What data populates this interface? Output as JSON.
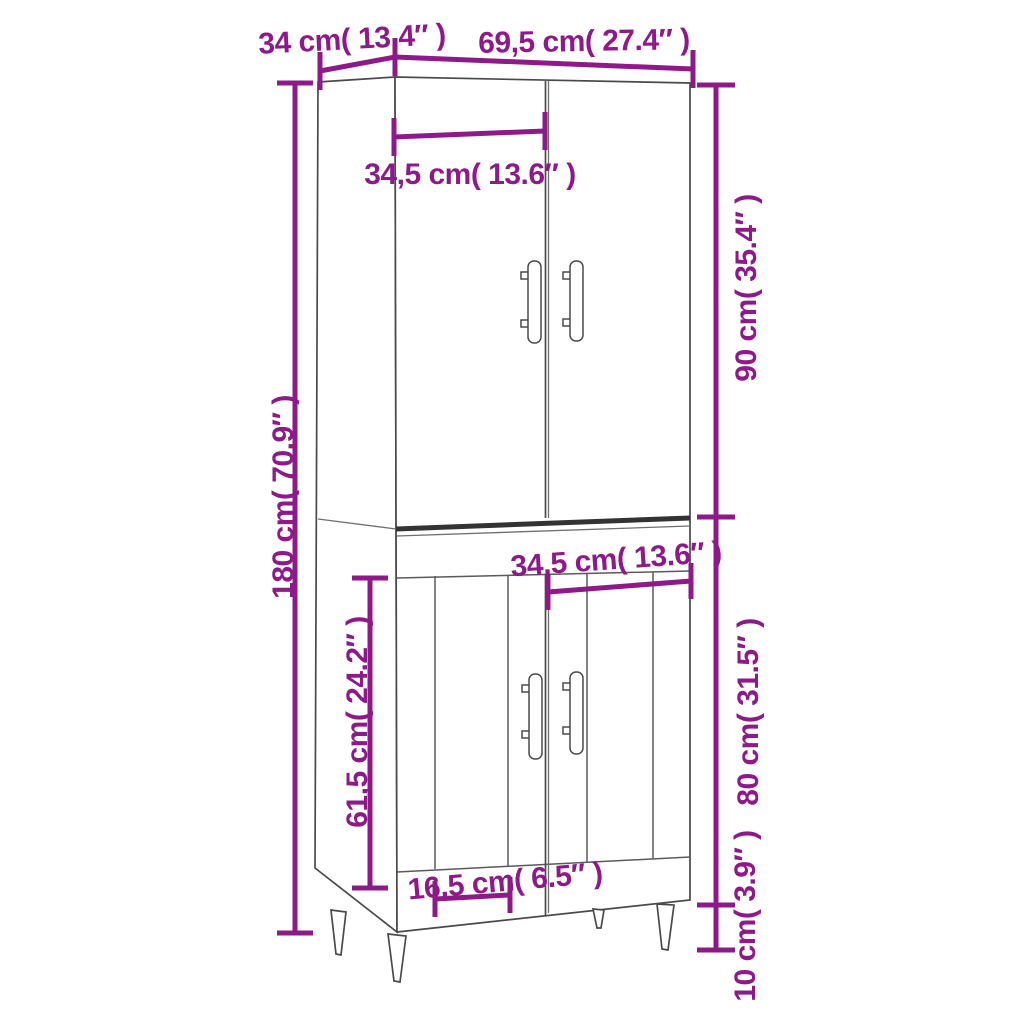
{
  "page": {
    "background_color": "#ffffff"
  },
  "diagram": {
    "accent_color": "#8d1a88",
    "outline_color": "#4a4a4a",
    "labels": {
      "top_depth": "34 cm( 13.4″ )",
      "top_width": "69,5 cm( 27.4″ )",
      "upper_door_width": "34,5 cm( 13.6″ )",
      "total_height": "180 cm( 70.9″ )",
      "upper_section_height": "90 cm( 35.4″ )",
      "lower_door_width": "34,5 cm( 13.6″ )",
      "lower_inner_height": "61,5 cm( 24.2″ )",
      "lower_section_height": "80 cm( 31.5″ )",
      "lower_panel_width": "16,5 cm( 6.5″ )",
      "leg_height": "10 cm( 3.9″ )"
    }
  }
}
